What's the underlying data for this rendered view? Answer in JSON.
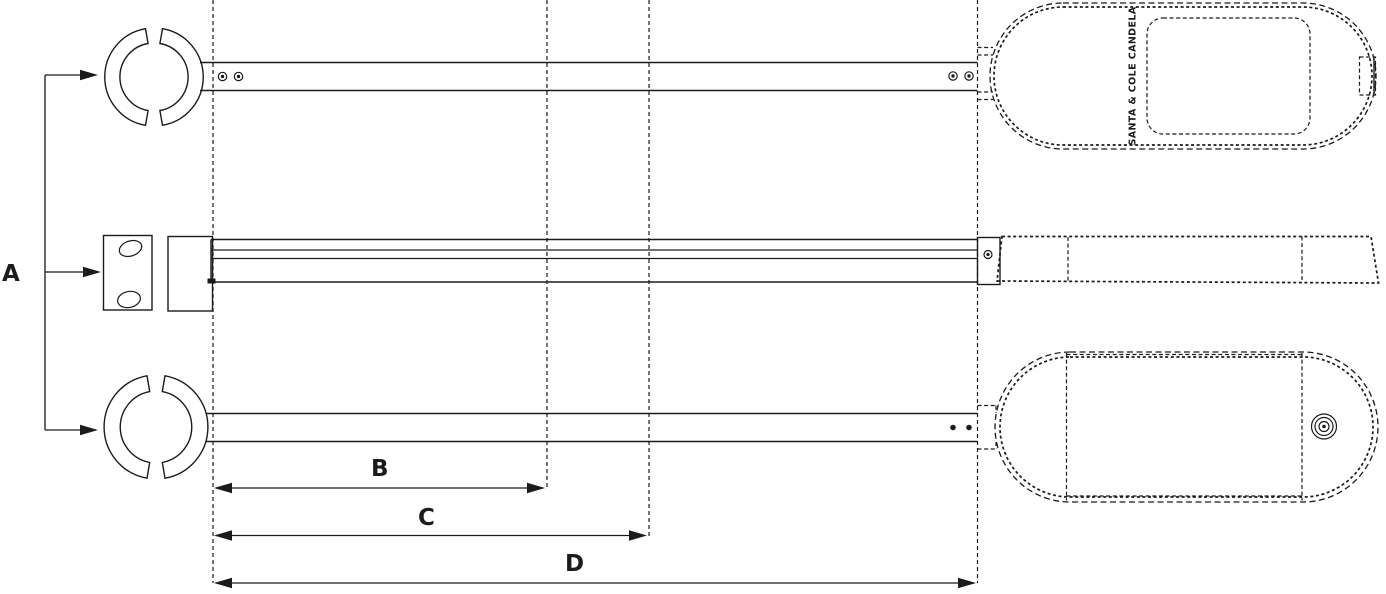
{
  "drawing": {
    "labels": {
      "dim_a": "A",
      "dim_b": "B",
      "dim_c": "C",
      "dim_d": "D"
    },
    "head": {
      "brand_text": "SANTA & COLE CANDELA"
    },
    "colors": {
      "line": "#1b1b1b",
      "background": "#ffffff"
    }
  }
}
